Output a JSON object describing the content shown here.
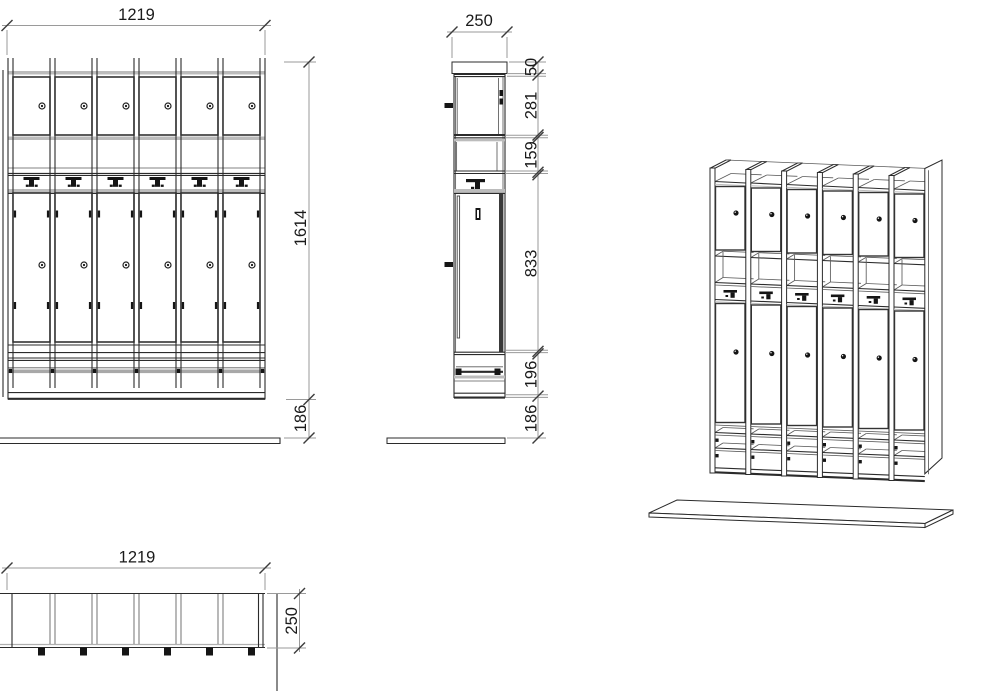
{
  "drawing": {
    "colors": {
      "background": "#ffffff",
      "line": "#2b2b2b",
      "door_outline": "#333333",
      "shelf_band_gray": "#bcbcbc",
      "dimension_line": "#9a9a9a",
      "dimension_text": "#1a1a1a",
      "hardware_black": "#151515"
    },
    "views": {
      "front": {
        "compartments": 6,
        "hooks": 6,
        "upper_doors": 6,
        "lower_doors": 6,
        "dim_width": "1219",
        "dim_height": "1614",
        "dim_bench_gap": "186"
      },
      "side": {
        "dim_depth": "250",
        "dim_top_strip": "50",
        "dim_upper_door": "281",
        "dim_shelf_gap": "159",
        "dim_lower_door": "833",
        "dim_base": "196",
        "dim_bench_gap": "186"
      },
      "plan": {
        "compartments": 6,
        "knobs": 6,
        "dim_width": "1219",
        "dim_depth": "250"
      },
      "isometric": {
        "compartments": 6,
        "knobs_per_compartment": 2,
        "hooks": 6,
        "bottom_shelves": 2
      }
    }
  }
}
